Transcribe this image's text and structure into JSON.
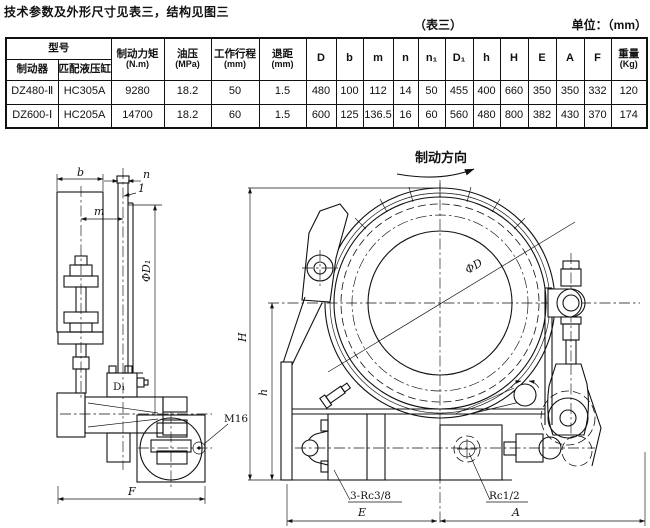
{
  "page": {
    "title": "技术参数及外形尺寸见表三，结构见图三",
    "table_tag": "（表三）",
    "unit": "单位：（mm）"
  },
  "table": {
    "model_header": "型号",
    "model_sub_headers": [
      "制动器",
      "匹配液压缸"
    ],
    "columns": [
      {
        "label": "制动力矩",
        "sub": "(N.m)"
      },
      {
        "label": "油压",
        "sub": "(MPa)"
      },
      {
        "label": "工作行程",
        "sub": "(mm)"
      },
      {
        "label": "退距",
        "sub": "(mm)"
      },
      {
        "label": "D",
        "sub": ""
      },
      {
        "label": "b",
        "sub": ""
      },
      {
        "label": "m",
        "sub": ""
      },
      {
        "label": "n",
        "sub": ""
      },
      {
        "label": "n₁",
        "sub": ""
      },
      {
        "label": "D₁",
        "sub": ""
      },
      {
        "label": "h",
        "sub": ""
      },
      {
        "label": "H",
        "sub": ""
      },
      {
        "label": "E",
        "sub": ""
      },
      {
        "label": "A",
        "sub": ""
      },
      {
        "label": "F",
        "sub": ""
      },
      {
        "label": "重量",
        "sub": "(Kg)"
      }
    ],
    "rows": [
      [
        "DZ480-Ⅱ",
        "HC305A",
        "9280",
        "18.2",
        "50",
        "1.5",
        "480",
        "100",
        "112",
        "14",
        "50",
        "455",
        "400",
        "660",
        "350",
        "350",
        "332",
        "120"
      ],
      [
        "DZ600-Ⅰ",
        "HC205A",
        "14700",
        "18.2",
        "60",
        "1.5",
        "600",
        "125",
        "136.5",
        "16",
        "60",
        "560",
        "480",
        "800",
        "382",
        "430",
        "370",
        "174"
      ]
    ]
  },
  "drawing": {
    "direction": "制动方向",
    "labels": {
      "b": "b",
      "n": "n",
      "gap": "1",
      "m": "m",
      "phiD1": "ΦD₁",
      "valve": "D₁",
      "m16": "M16",
      "F": "F",
      "H": "H",
      "h": "h",
      "phiD": "ΦD",
      "port3": "3-Rc3/8",
      "port1": "Rc1/2",
      "E": "E",
      "A": "A"
    }
  }
}
